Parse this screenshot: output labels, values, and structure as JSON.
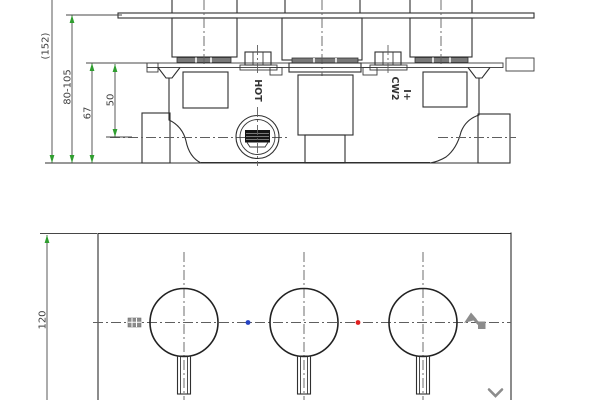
{
  "top_view": {
    "dim_overall": "(152)",
    "dim_depth_range": "80-105",
    "dim_body": "67",
    "dim_outlet": "50",
    "label_hot": "HOT",
    "label_cw2": "CW2",
    "label_cw2_mark": "I+"
  },
  "bottom_view": {
    "dim_height": "120"
  },
  "colors": {
    "line": "#2f2f2f",
    "centerline": "#5f5f5f",
    "dim_text": "#3f3f3f",
    "arrow_green": "#2f9e2f",
    "marker_blue": "#2543c4",
    "marker_red": "#e01f1f",
    "ui_gray": "#8c8c8c",
    "hatch_dark": "#161616"
  }
}
